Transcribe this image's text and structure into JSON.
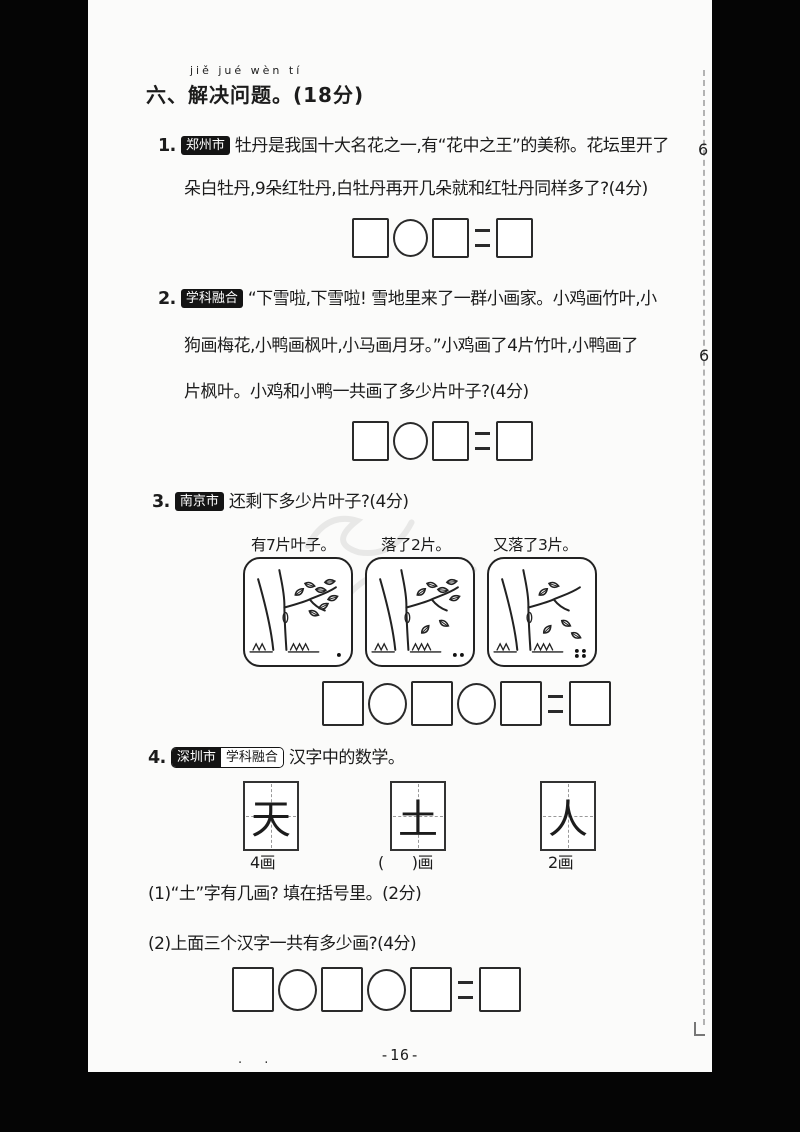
{
  "section_header": {
    "pinyin": "jiě jué wèn tí",
    "title": "六、解决问题。",
    "points": "(18分)"
  },
  "questions": {
    "q1": {
      "number": "1.",
      "badge": "郑州市",
      "line1": "牡丹是我国十大名花之一,有“花中之王”的美称。花坛里开了",
      "edge_digit": "6",
      "line2": "朵白牡丹,9朵红牡丹,白牡丹再开几朵就和红牡丹同样多了?(4分)"
    },
    "q2": {
      "number": "2.",
      "badge": "学科融合",
      "line1": "“下雪啦,下雪啦! 雪地里来了一群小画家。小鸡画竹叶,小",
      "line2": "狗画梅花,小鸭画枫叶,小马画月牙。”小鸡画了4片竹叶,小鸭画了",
      "edge_digit": "6",
      "line3": "片枫叶。小鸡和小鸭一共画了多少片叶子?(4分)"
    },
    "q3": {
      "number": "3.",
      "badge": "南京市",
      "text": "还剩下多少片叶子?(4分)",
      "panels": [
        {
          "caption": "有7片叶子。",
          "leaves_on_tree": 7,
          "leaves_fallen": 0,
          "corner_dots": 1
        },
        {
          "caption": "落了2片。",
          "leaves_on_tree": 5,
          "leaves_fallen": 2,
          "corner_dots": 2
        },
        {
          "caption": "又落了3片。",
          "leaves_on_tree": 2,
          "leaves_fallen": 3,
          "corner_dots": 4
        }
      ]
    },
    "q4": {
      "number": "4.",
      "badge_city": "深圳市",
      "badge_subject": "学科融合",
      "text": "汉字中的数学。",
      "cards": [
        {
          "char": "天",
          "label": "4画"
        },
        {
          "char": "土",
          "label_open": "(",
          "label_close": ")画"
        },
        {
          "char": "人",
          "label": "2画"
        }
      ],
      "sub1": "(1)“土”字有几画? 填在括号里。(2分)",
      "sub2": "(2)上面三个汉字一共有多少画?(4分)"
    }
  },
  "equations": [
    {
      "size": "sm",
      "shapes": [
        "square",
        "circle",
        "square",
        "equals",
        "square"
      ]
    },
    {
      "size": "sm",
      "shapes": [
        "square",
        "circle",
        "square",
        "equals",
        "square"
      ]
    },
    {
      "size": "lg",
      "shapes": [
        "square",
        "circle",
        "square",
        "circle",
        "square",
        "equals",
        "square"
      ]
    },
    {
      "size": "lg",
      "shapes": [
        "square",
        "circle",
        "square",
        "circle",
        "square",
        "equals",
        "square"
      ]
    }
  ],
  "footer": {
    "page_number": "-16-",
    "stray_marks": ". ."
  }
}
